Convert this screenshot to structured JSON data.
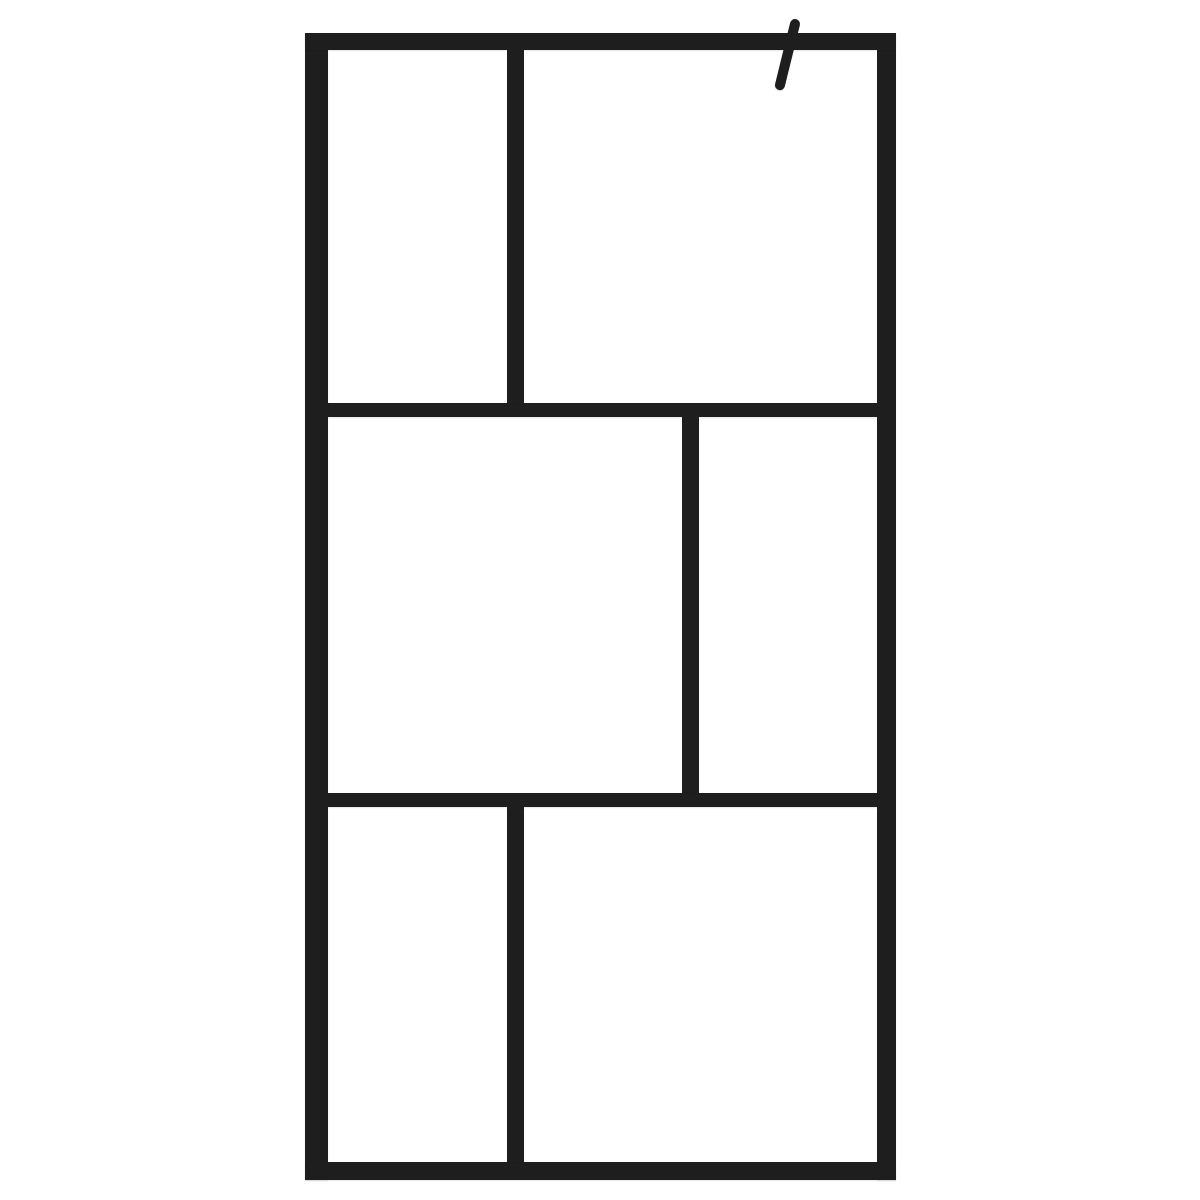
{
  "meta": {
    "description": "Product photo of a walk-in shower screen: clear glass with a black aluminium grid frame of six panes and an angled wall support arm at the top right, on a plain white background.",
    "background_color": "#ffffff",
    "frame_color": "#1e1e1e"
  },
  "figure": {
    "canvas": {
      "width": 1200,
      "height": 1200
    },
    "frame_color": "#1e1e1e",
    "bars": [
      {
        "name": "frame-left-stile",
        "x": 305,
        "y": 33,
        "w": 23,
        "h": 1147
      },
      {
        "name": "frame-right-stile",
        "x": 877,
        "y": 33,
        "w": 19,
        "h": 1147
      },
      {
        "name": "frame-top-rail",
        "x": 305,
        "y": 33,
        "w": 591,
        "h": 17
      },
      {
        "name": "frame-bottom-rail",
        "x": 305,
        "y": 1162,
        "w": 591,
        "h": 18
      },
      {
        "name": "middle-rail-upper",
        "x": 328,
        "y": 403,
        "w": 549,
        "h": 14
      },
      {
        "name": "middle-rail-lower",
        "x": 328,
        "y": 793,
        "w": 549,
        "h": 14
      },
      {
        "name": "mullion-top-row",
        "x": 507,
        "y": 50,
        "w": 17,
        "h": 353
      },
      {
        "name": "mullion-middle-row",
        "x": 682,
        "y": 417,
        "w": 17,
        "h": 376
      },
      {
        "name": "mullion-bottom-row",
        "x": 507,
        "y": 807,
        "w": 17,
        "h": 355
      }
    ],
    "panes": [
      {
        "name": "glass-pane-top-left",
        "x": 328,
        "y": 50,
        "w": 179,
        "h": 353
      },
      {
        "name": "glass-pane-top-right",
        "x": 524,
        "y": 50,
        "w": 353,
        "h": 353
      },
      {
        "name": "glass-pane-middle-left",
        "x": 328,
        "y": 417,
        "w": 354,
        "h": 376
      },
      {
        "name": "glass-pane-middle-right",
        "x": 699,
        "y": 417,
        "w": 178,
        "h": 376
      },
      {
        "name": "glass-pane-bottom-left",
        "x": 328,
        "y": 807,
        "w": 179,
        "h": 355
      },
      {
        "name": "glass-pane-bottom-right",
        "x": 524,
        "y": 807,
        "w": 353,
        "h": 355
      }
    ],
    "support_arm": {
      "name": "wall-support-arm",
      "x1": 795,
      "y1": 24,
      "x2": 780,
      "y2": 85,
      "thickness": 10,
      "color": "#1e1e1e"
    }
  }
}
